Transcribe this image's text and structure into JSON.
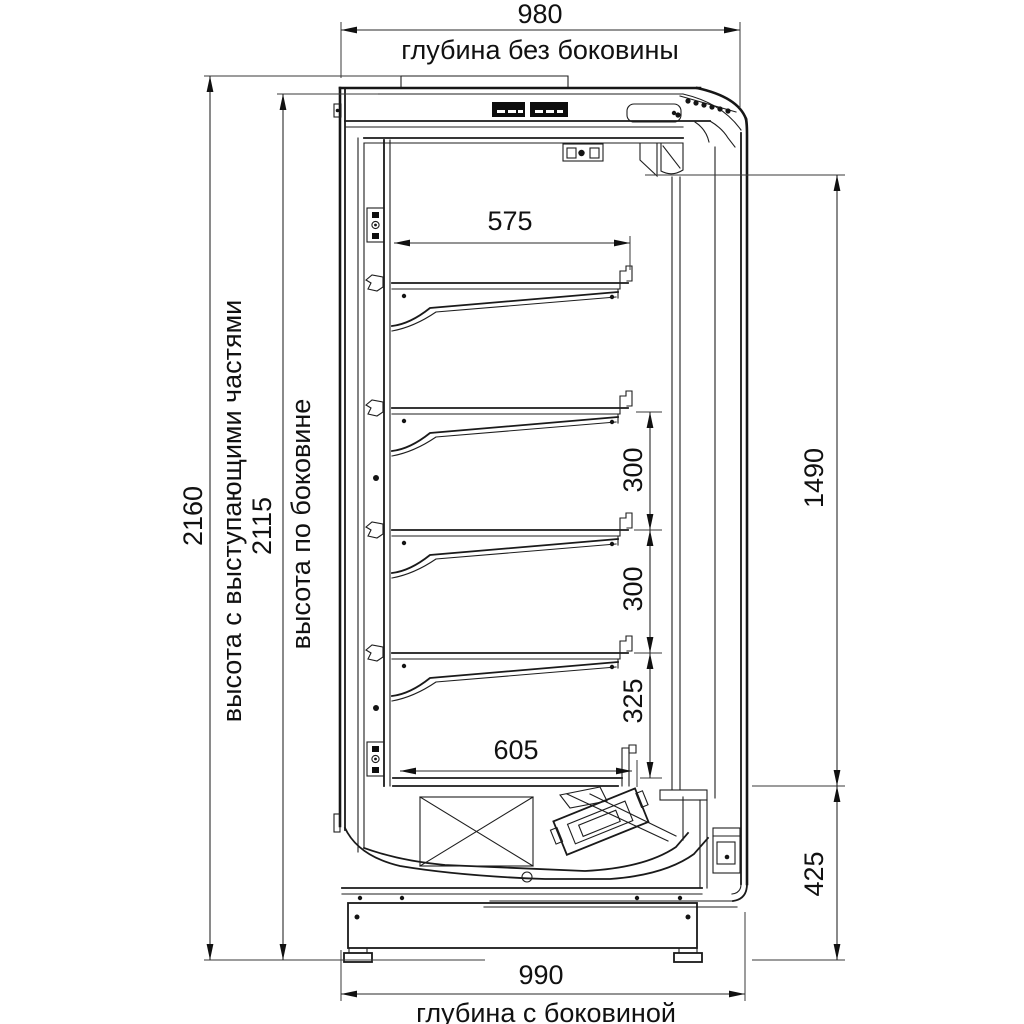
{
  "drawing": {
    "kind": "side-section technical drawing",
    "language": "ru",
    "colors": {
      "line": "#1a1a1a",
      "background": "#ffffff"
    }
  },
  "dimensions": {
    "depth_without_side": {
      "value": "980",
      "label": "глубина без боковины"
    },
    "height_overall": {
      "value": "2160",
      "label": "высота с выступающими частями"
    },
    "height_side_panel": {
      "value": "2115",
      "label": "высота по боковине"
    },
    "shelf_top_width": {
      "value": "575"
    },
    "shelf_gap_a": {
      "value": "300"
    },
    "shelf_gap_b": {
      "value": "300"
    },
    "shelf_gap_c": {
      "value": "325"
    },
    "shelf_bottom_width": {
      "value": "605"
    },
    "inner_height": {
      "value": "1490"
    },
    "base_height": {
      "value": "425"
    },
    "depth_with_side": {
      "value": "990",
      "label": "глубина с боковиной"
    }
  }
}
